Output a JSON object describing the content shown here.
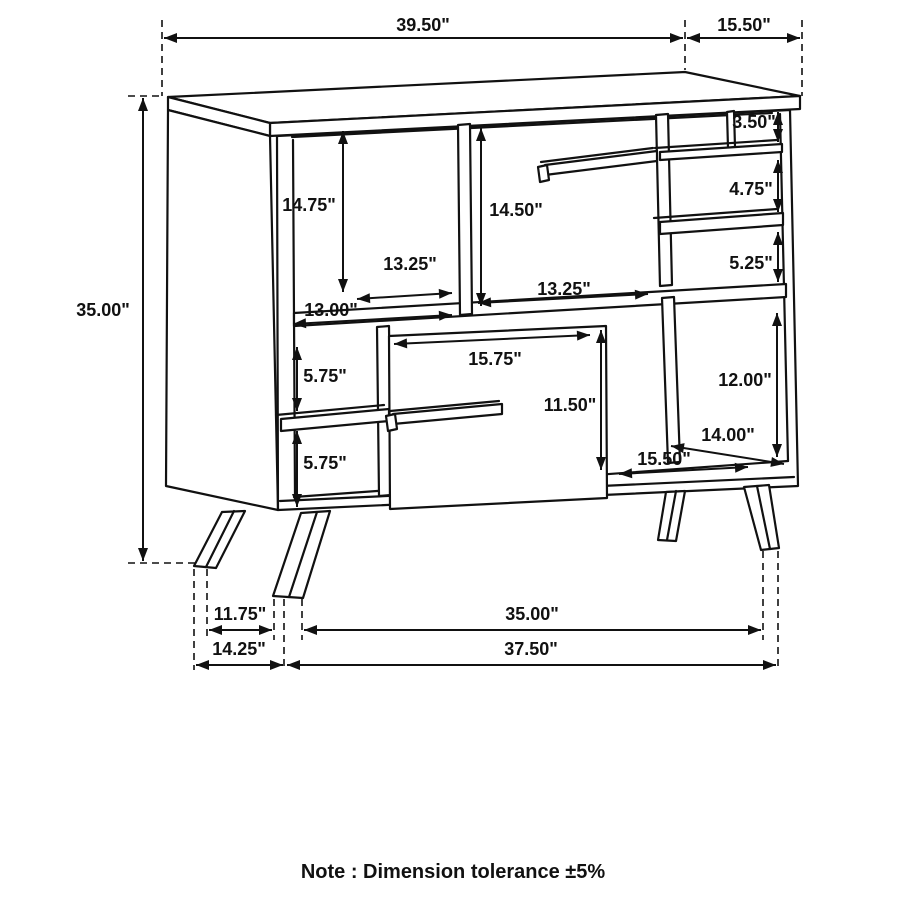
{
  "note": "Note : Dimension tolerance ±5%",
  "colors": {
    "ink": "#111111",
    "background": "#ffffff"
  },
  "dimensions": {
    "overall_width": "39.50\"",
    "overall_depth": "15.50\"",
    "overall_height": "35.00\"",
    "upper_left_opening_height": "14.75\"",
    "upper_center_opening_height": "14.50\"",
    "upper_left_opening_width": "13.25\"",
    "upper_center_opening_width": "13.25\"",
    "upper_left_shelf_width": "13.00\"",
    "right_cubby_top_height": "3.50\"",
    "right_cubby_middle_height": "4.75\"",
    "right_cubby_bottom_height": "5.25\"",
    "lower_left_cubby_top_height": "5.75\"",
    "lower_left_cubby_bottom_height": "5.75\"",
    "door_width": "15.75\"",
    "door_height": "11.50\"",
    "lower_right_opening_height": "12.00\"",
    "lower_right_opening_depth": "14.00\"",
    "lower_right_opening_width": "15.50\"",
    "leg_clearance_depth": "11.75\"",
    "leg_span_depth": "14.25\"",
    "leg_span_width": "35.00\"",
    "base_width": "37.50\""
  }
}
